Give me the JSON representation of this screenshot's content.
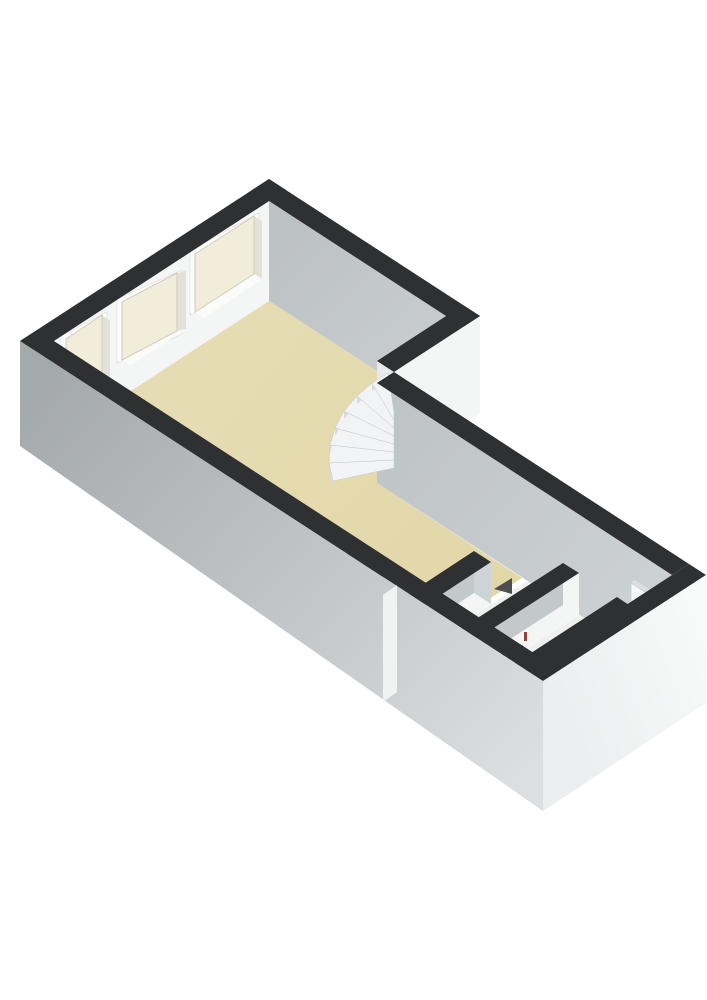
{
  "page_bg": "#ffffff",
  "scene": {
    "type": "3d-floor-plan-render",
    "view": "isometric-from-south-west",
    "rooms": [
      {
        "name": "living-room-with-kitchen",
        "floor_style": "beige"
      },
      {
        "name": "hallway",
        "floor_style": "white"
      },
      {
        "name": "middle-small-room",
        "floor_style": "white"
      },
      {
        "name": "right-small-room",
        "floor_style": "white"
      }
    ],
    "features": [
      "three-recessed-windows-on-upper-left-wall",
      "winder-staircase-at-wall-corner",
      "kitchen-unit-with-four-burner-cooktop",
      "door-opening-with-dark-door-wedge",
      "radiator-marks-in-middle-room",
      "open-door-leaf-in-right-room"
    ]
  },
  "colors": {
    "page_bg": "#ffffff",
    "wall_top": "#2f3032",
    "wall_white": "#f4f5f5",
    "wall_white_dim": "#e7e9ea",
    "wall_gray": "#c3c8ca",
    "wall_gray_light": "#ced3d5",
    "corridor_gray_dark": "#bfc4c6",
    "corridor_gray_light": "#cdd2d4",
    "ne_inner_dark": "#bcc1c3",
    "ne_inner_light": "#cacfd1",
    "outer_sw_dark": "#a4a9ab",
    "outer_sw_light": "#dcdedf",
    "outer_se_dark": "#ebedee",
    "outer_se_light": "#f8f9f9",
    "floor_main": "#e1d7a8",
    "floor_main_light": "#e7ddb4",
    "floor_light": "#efefee",
    "glass": "#f2edda",
    "glass_frame_line": "#cfccba",
    "frame_white": "#fdfdfd",
    "window_reveal": "#e4e2d8",
    "window_sill": "#fbfbfa",
    "stair_tread": "#f1f3f4",
    "stair_riser": "#d7dbdd",
    "stove_top": "#f6f7f7",
    "stove_side_sw": "#e2e4e5",
    "stove_side_se": "#eff0f1",
    "cooktop": "#1d1d1d",
    "burner": "#c53029",
    "burner_center": "#6e100c",
    "door_wedge": "#4c4e4f",
    "radiator_dark": "#3a3a3a",
    "radiator_valve": "#8f4134",
    "door_leaf": "#f6f7f7",
    "jog_face": "#f1f2f2"
  }
}
